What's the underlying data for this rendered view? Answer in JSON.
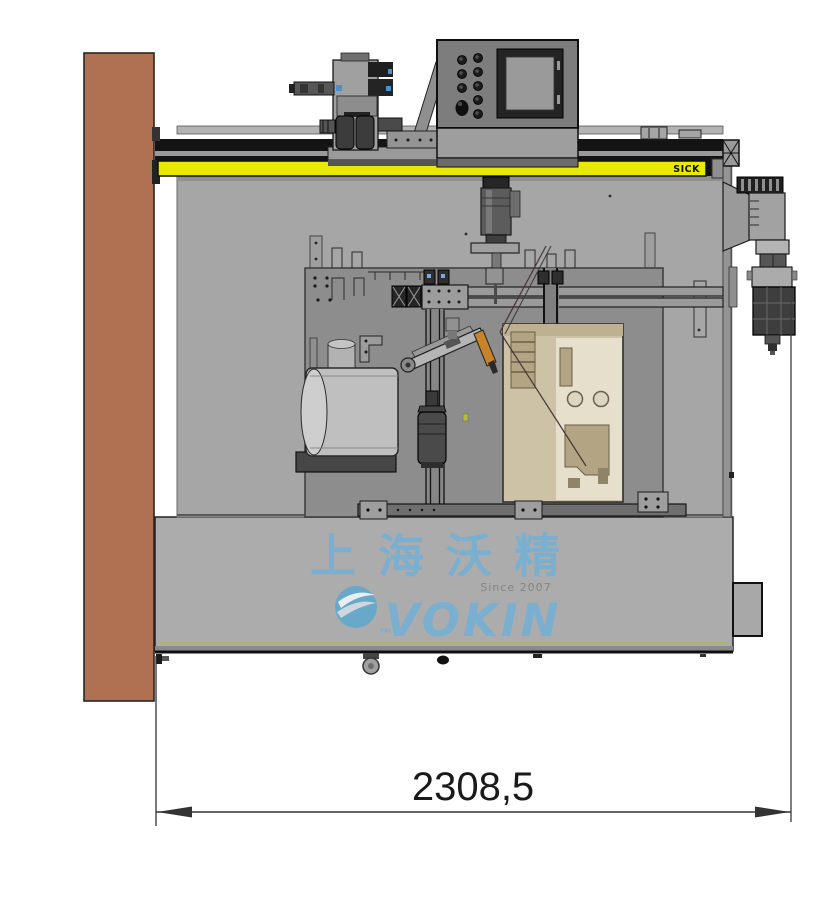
{
  "drawing": {
    "safety_bar_label": "SICK",
    "dimension": {
      "value": "2308,5"
    },
    "watermark": {
      "chinese_name": "上海沃精",
      "since": "Since 2007",
      "brand": "VOKIN",
      "trademark": "TM"
    },
    "colors": {
      "wall_brown": "#b07152",
      "machine_gray": "#a6a6a6",
      "base_gray": "#acacac",
      "inner_plate_gray": "#8d8d8d",
      "safety_yellow": "#e9e900",
      "watermark_blue": "#74b0d4",
      "logo_blue": "#5fa8cc",
      "since_gray": "#7f7f7f",
      "window_beige": "#cdc2a6",
      "tool_orange": "#c8822a",
      "dimension_ink": "#1a1a1a"
    }
  }
}
